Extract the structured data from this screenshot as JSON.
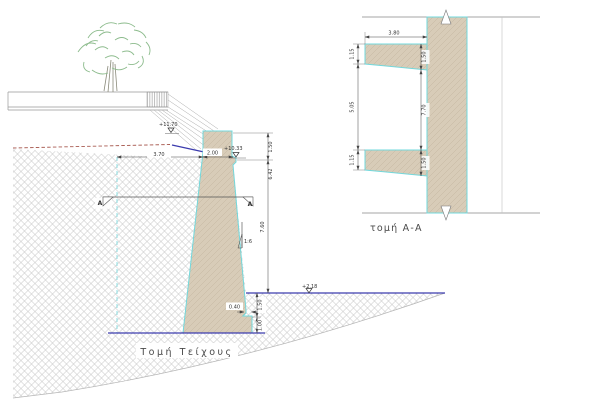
{
  "main_section": {
    "title": "Τομή Τείχους",
    "marker_letter": "A",
    "elevations": {
      "crest": "+11.70",
      "front": "+10.33",
      "water": "+2.18"
    },
    "dims": {
      "backfill_width": "3.70",
      "crown_width": "2.00",
      "toe_step": "0.40",
      "batter": "1:6"
    },
    "right_chain": [
      "1.50",
      "6.42",
      "7.60"
    ],
    "bottom_chain": [
      "1.50",
      "1.00"
    ]
  },
  "section_aa": {
    "title": "τομή Α-Α",
    "dims": {
      "buttress_length": "3.80"
    },
    "left_chain": [
      "1.15",
      "5.05",
      "1.15"
    ],
    "face_chain": [
      "1.50",
      "7.70",
      "1.50"
    ]
  },
  "colors": {
    "wall_fill": "#d8ccb8",
    "outline_cyan": "#72d8dc",
    "line_blue": "#3c3cae",
    "line_red": "#a85a50",
    "hatch_gray": "#cdcdcd",
    "dim_line": "#444444"
  }
}
